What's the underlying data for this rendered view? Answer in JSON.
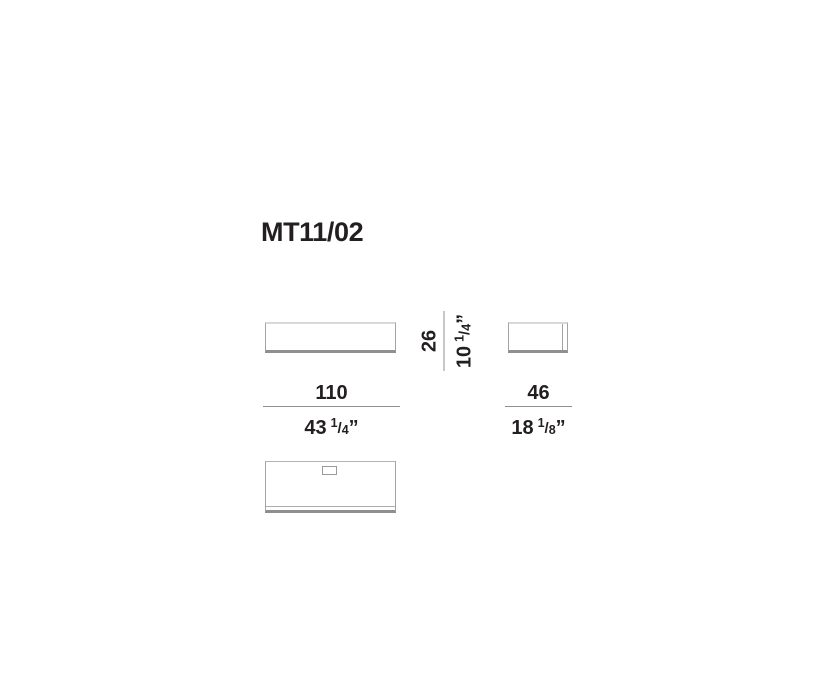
{
  "product": {
    "model": "MT11/02"
  },
  "dimensions": {
    "width": {
      "metric": "110",
      "imperial_whole": "43",
      "fraction_numerator": "1",
      "fraction_denominator": "4",
      "unit_mark": "”"
    },
    "height": {
      "metric": "26",
      "imperial_whole": "10",
      "fraction_numerator": "1",
      "fraction_denominator": "4",
      "unit_mark": "”"
    },
    "depth": {
      "metric": "46",
      "imperial_whole": "18",
      "fraction_numerator": "1",
      "fraction_denominator": "8",
      "unit_mark": "”"
    }
  },
  "colors": {
    "text": "#231f20",
    "outline_light": "#d9d9d9",
    "outline_mid": "#a3a3a3",
    "outline_dark": "#8f8f8f",
    "dimension_line": "#8f8f8f",
    "background": "#ffffff"
  }
}
